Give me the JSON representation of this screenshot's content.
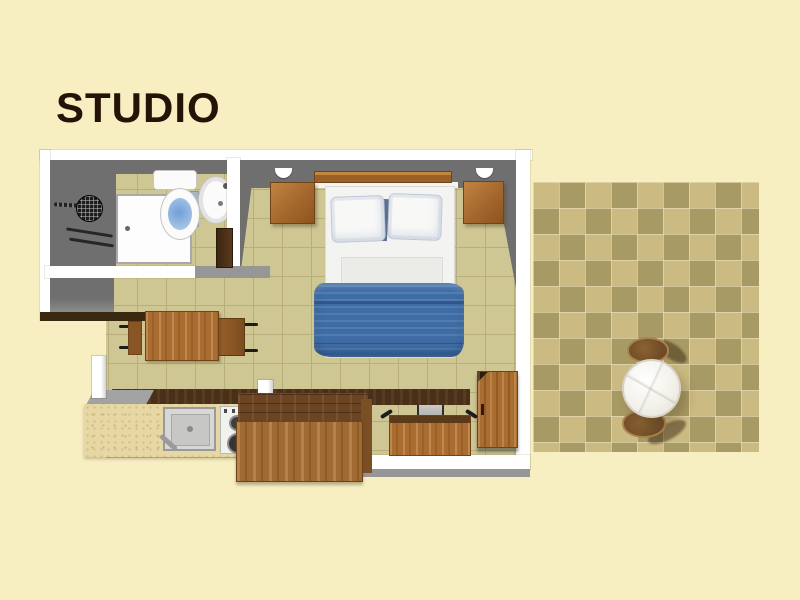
{
  "title": "STUDIO",
  "colors": {
    "bg": "#f7efc2",
    "title_text": "#241306",
    "wall_white": "#ffffff",
    "wall_gray": "#6f6f6f",
    "wall_gray_light": "#969696",
    "floor_tile": "#cfc793",
    "floor_grout": "#b9ae7a",
    "terr_light": "#cbba82",
    "terr_dark": "#a89a64",
    "terr_chair": "#6f4b26",
    "wood": "#a96c31",
    "wood_dark": "#6e4418",
    "worktop_dark": "#4a3019",
    "counter_speckle": "#e6d7a5",
    "blanket_blue": "#3e6da6",
    "linen_white": "#f3f3f1",
    "shelf_dark": "#3a2710",
    "toilet_water": "#a8c4e6"
  },
  "scene": {
    "type": "studio-apartment-floor-plan",
    "areas": [
      {
        "name": "bathroom",
        "items": [
          "shower-head",
          "shower-arm",
          "towel-rail",
          "bathroom-door",
          "bathroom-door-leaf",
          "toilet",
          "toilet-cistern",
          "washbasin"
        ]
      },
      {
        "name": "main-room",
        "items": [
          "double-bed",
          "pillow-left",
          "pillow-right",
          "blue-blanket",
          "headboard",
          "nightstand-left",
          "nightstand-right",
          "wall-lamp-left",
          "wall-lamp-right",
          "dining-table",
          "dining-chair-left",
          "dining-chair-right",
          "desk",
          "desk-chair",
          "wardrobe",
          "wall-shelf"
        ]
      },
      {
        "name": "kitchenette",
        "items": [
          "speckled-counter",
          "kitchen-sink",
          "two-burner-stove",
          "dark-worktop",
          "wood-cabinet-island",
          "extractor-hood"
        ]
      },
      {
        "name": "terrace",
        "items": [
          "checkered-tile-floor",
          "round-table",
          "terrace-chair-top",
          "terrace-chair-bottom"
        ]
      }
    ]
  }
}
